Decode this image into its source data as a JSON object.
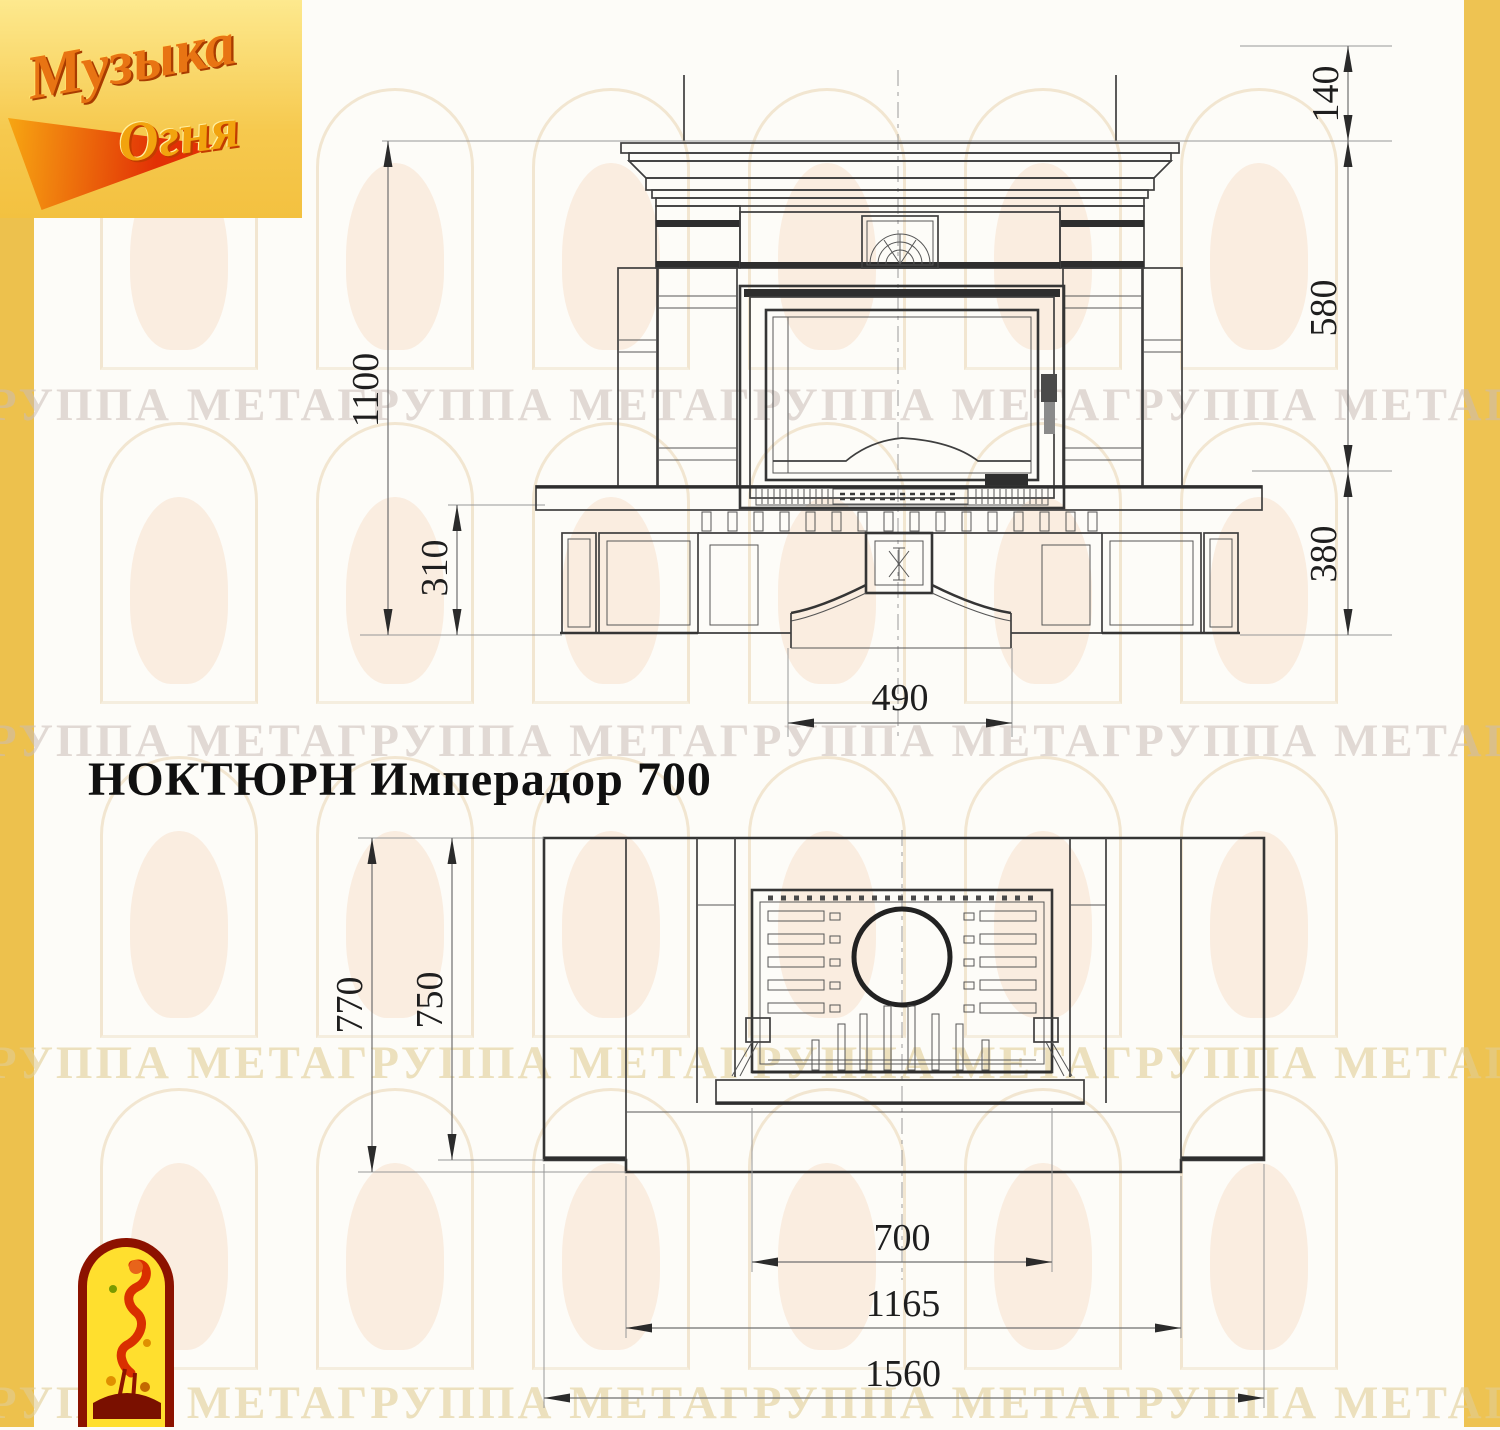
{
  "title": {
    "text": "НОКТЮРН Имперадор 700"
  },
  "brand": {
    "line1": "Музыка",
    "line2": "Огня"
  },
  "watermark": {
    "row_text": "ГРУППА МЕТАГРУППА МЕТАГРУППА МЕТАГРУППА МЕТАГРУППА МЕТА"
  },
  "colors": {
    "side_band": "#edc14d",
    "logo_bg": "#f6c94e",
    "firebird_red": "#d92f00"
  },
  "front_view": {
    "dims": {
      "total_height": "1100",
      "hearth_height": "310",
      "top_offset": "140",
      "firebox_zone": "580",
      "base_height": "380",
      "opening_width": "490"
    }
  },
  "plan_view": {
    "dims": {
      "total_depth": "770",
      "body_depth": "750",
      "insert_width": "700",
      "inner_width": "1165",
      "total_width": "1560"
    }
  }
}
